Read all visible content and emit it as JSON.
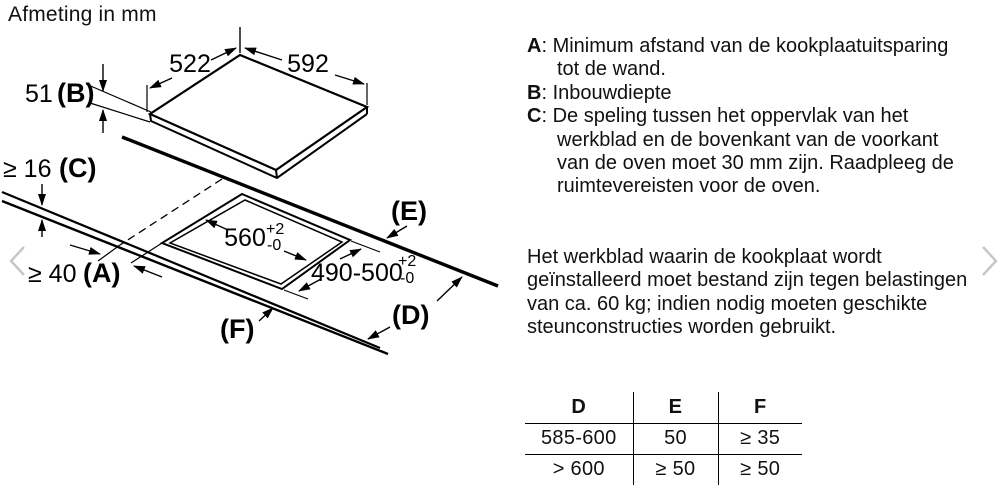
{
  "title": "Afmeting in mm",
  "carousel": {
    "prev_icon": "chevron-left",
    "next_icon": "chevron-right"
  },
  "diagram": {
    "hob_depth_label": "522",
    "hob_width_label": "592",
    "build_in_depth": {
      "value": "51",
      "key": "(B)"
    },
    "worktop_thickness": {
      "value": "≥ 16",
      "key": "(C)"
    },
    "wall_clearance": {
      "value": "≥ 40",
      "key": "(A)"
    },
    "cutout_depth": {
      "value": "560",
      "tol_plus": "+2",
      "tol_minus": "-0"
    },
    "cutout_width": {
      "value": "490-500",
      "tol_plus": "+2",
      "tol_minus": "-0"
    },
    "label_e": "(E)",
    "label_d": "(D)",
    "label_f": "(F)"
  },
  "legend": [
    {
      "key": "A",
      "text": ": Minimum afstand van de kookplaatuitsparing tot de wand."
    },
    {
      "key": "B",
      "text": ": Inbouwdiepte"
    },
    {
      "key": "C",
      "text": ": De speling tussen het oppervlak van het werkblad en de bovenkant van de voorkant van de oven moet 30 mm zijn. Raadpleeg de ruimtevereisten voor de oven."
    }
  ],
  "note": "Het werkblad waarin de kookplaat wordt geïnstalleerd moet bestand zijn tegen belastingen van ca. 60 kg; indien nodig moeten geschikte steunconstructies worden gebruikt.",
  "table": {
    "headers": [
      "D",
      "E",
      "F"
    ],
    "rows": [
      [
        "585-600",
        "50",
        "≥ 35"
      ],
      [
        "> 600",
        "≥ 50",
        "≥ 50"
      ]
    ]
  }
}
